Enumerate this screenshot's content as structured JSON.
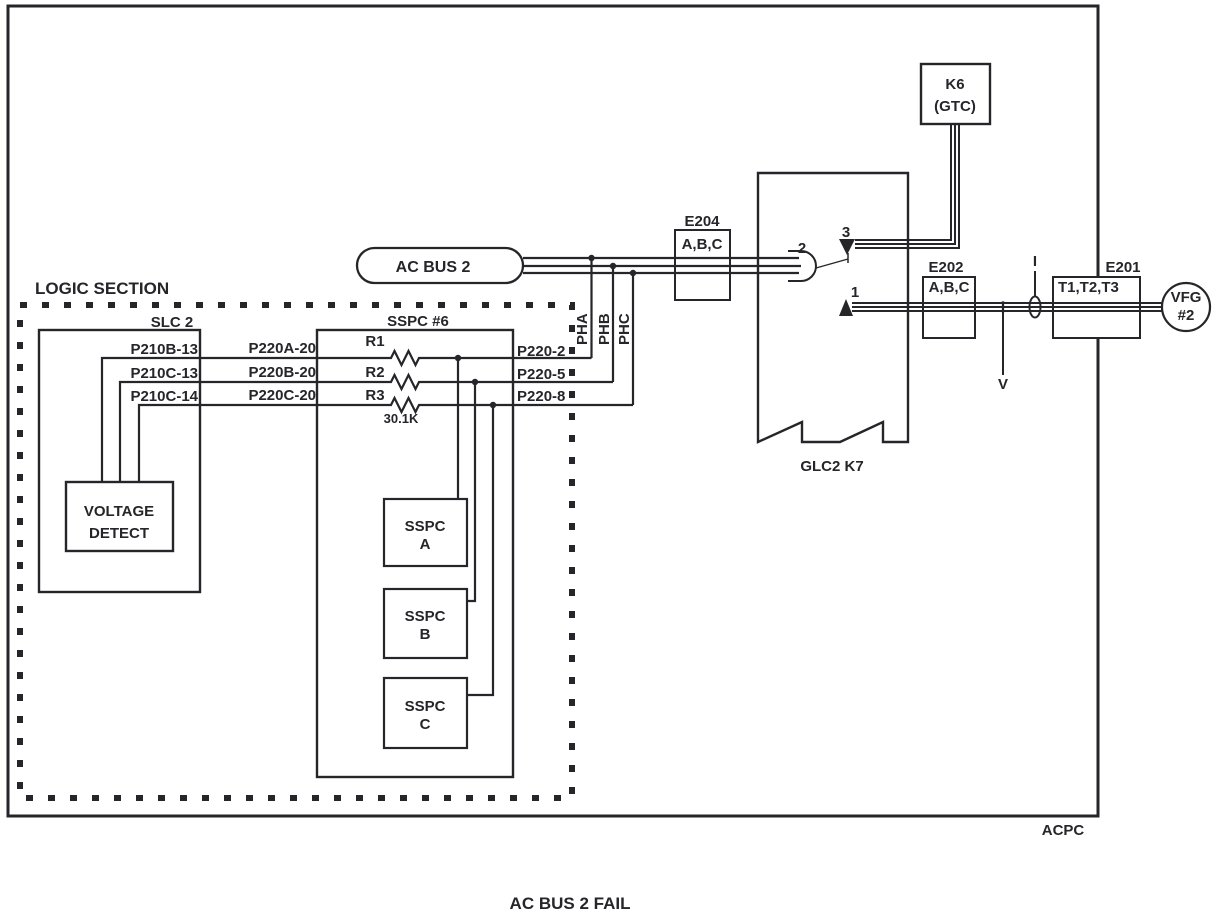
{
  "diagram_title": "AC BUS 2 FAIL",
  "colors": {
    "ink": "#26262a",
    "background": "#ffffff"
  },
  "acpc": {
    "label": "ACPC"
  },
  "logic_section": {
    "label": "LOGIC SECTION",
    "slc2": {
      "label": "SLC 2",
      "voltage_detect": {
        "line1": "VOLTAGE",
        "line2": "DETECT"
      }
    },
    "rows": [
      {
        "slc_pin": "P210B-13",
        "sspc_pin": "P220A-20",
        "resistor": "R1",
        "out_pin": "P220-2"
      },
      {
        "slc_pin": "P210C-13",
        "sspc_pin": "P220B-20",
        "resistor": "R2",
        "out_pin": "P220-5"
      },
      {
        "slc_pin": "P210C-14",
        "sspc_pin": "P220C-20",
        "resistor": "R3",
        "out_pin": "P220-8"
      }
    ],
    "resistor_value": "30.1K",
    "sspc6": {
      "label": "SSPC #6",
      "channel_a": {
        "line1": "SSPC",
        "line2": "A"
      },
      "channel_b": {
        "line1": "SSPC",
        "line2": "B"
      },
      "channel_c": {
        "line1": "SSPC",
        "line2": "C"
      }
    }
  },
  "bus": {
    "label": "AC BUS 2",
    "phase_a": "PHA",
    "phase_b": "PHB",
    "phase_c": "PHC"
  },
  "glc": {
    "label": "GLC2  K7",
    "contact1": "1",
    "contact2": "2",
    "contact3": "3"
  },
  "k6": {
    "line1": "K6",
    "line2": "(GTC)"
  },
  "connectors": {
    "e204": {
      "name": "E204",
      "pins": "A,B,C"
    },
    "e202": {
      "name": "E202",
      "pins": "A,B,C"
    },
    "e201": {
      "name": "E201",
      "pins": "T1,T2,T3"
    }
  },
  "meters": {
    "current": "I",
    "voltage": "V"
  },
  "vfg": {
    "line1": "VFG",
    "line2": "#2"
  }
}
